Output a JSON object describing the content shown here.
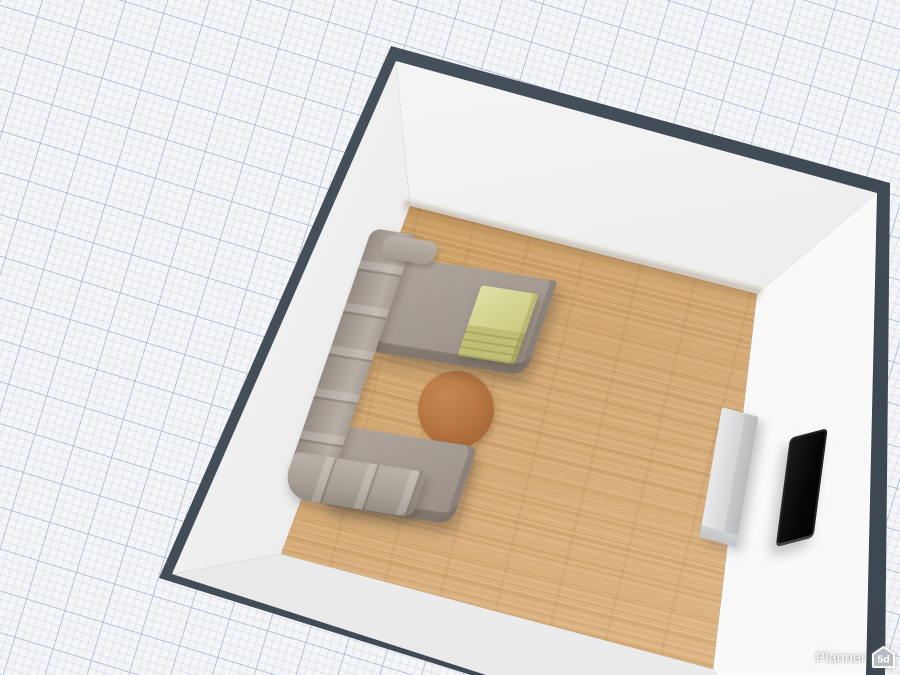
{
  "watermark": {
    "brand": "Planner",
    "badge": "5d",
    "badge_icon": "house-icon"
  },
  "scene": {
    "view": "3d-room-top-perspective",
    "background": {
      "name": "grid-paper",
      "base_color": "#f4f5f7",
      "major_line_color": "#c9d2e0",
      "minor_line_color": "#e3e6ee"
    },
    "room": {
      "wall_outline_color": "#424c57",
      "wall_face_color": "#efefef",
      "floor_material": "light-oak-wood",
      "floor_color": "#d2a771"
    },
    "objects": [
      {
        "name": "corner-sofa",
        "color": "#a8a097"
      },
      {
        "name": "sofa-ottoman-mattress",
        "color": "#d5d694"
      },
      {
        "name": "round-coffee-table",
        "color": "#b37741"
      },
      {
        "name": "sideboard-cabinet",
        "color": "#d6d8d9"
      },
      {
        "name": "wall-tv",
        "color": "#0a0a0a"
      }
    ]
  }
}
